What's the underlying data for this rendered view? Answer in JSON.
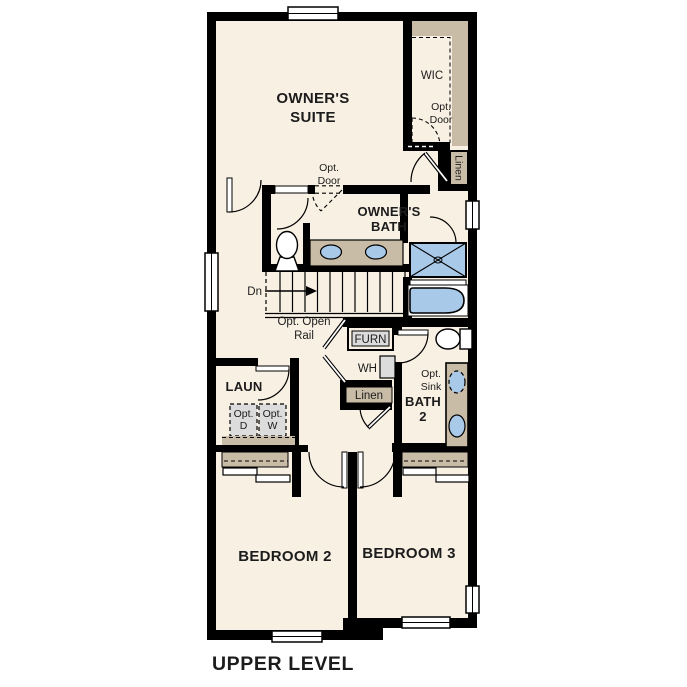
{
  "plan_title": "UPPER LEVEL",
  "colors": {
    "background": "#ffffff",
    "wall": "#000000",
    "floor": "#f8f0e3",
    "casework": "#c9bca7",
    "fixture": "#a9c9e9",
    "equipment": "#dcdcdc",
    "text": "#1c1c1c"
  },
  "rooms": {
    "owners_suite": [
      "OWNER'S",
      "SUITE"
    ],
    "wic": "WIC",
    "owners_bath": [
      "OWNER'S",
      "BATH"
    ],
    "laundry": "LAUN",
    "bath_2": [
      "BATH",
      "2"
    ],
    "bedroom_2": "BEDROOM 2",
    "bedroom_3": "BEDROOM 3"
  },
  "annotations": {
    "opt_door_wic": [
      "Opt.",
      "Door"
    ],
    "opt_door_suite": [
      "Opt.",
      "Door"
    ],
    "linen_upper": "Linen",
    "linen_hall": "Linen",
    "stair_direction": "Dn",
    "opt_open_rail": [
      "Opt. Open",
      "Rail"
    ],
    "furnace": "FURN",
    "water_heater": "WH",
    "opt_dryer": [
      "Opt.",
      "D"
    ],
    "opt_washer": [
      "Opt.",
      "W"
    ],
    "opt_sink": [
      "Opt.",
      "Sink"
    ]
  },
  "fixtures": [
    "toilet",
    "double-sink-vanity",
    "shower",
    "bathtub",
    "toilet-2",
    "optional-sink",
    "sink",
    "optional-washer",
    "optional-dryer",
    "furnace",
    "water-heater",
    "stairs-down",
    "linen-closet",
    "bypass-closet-doors"
  ]
}
